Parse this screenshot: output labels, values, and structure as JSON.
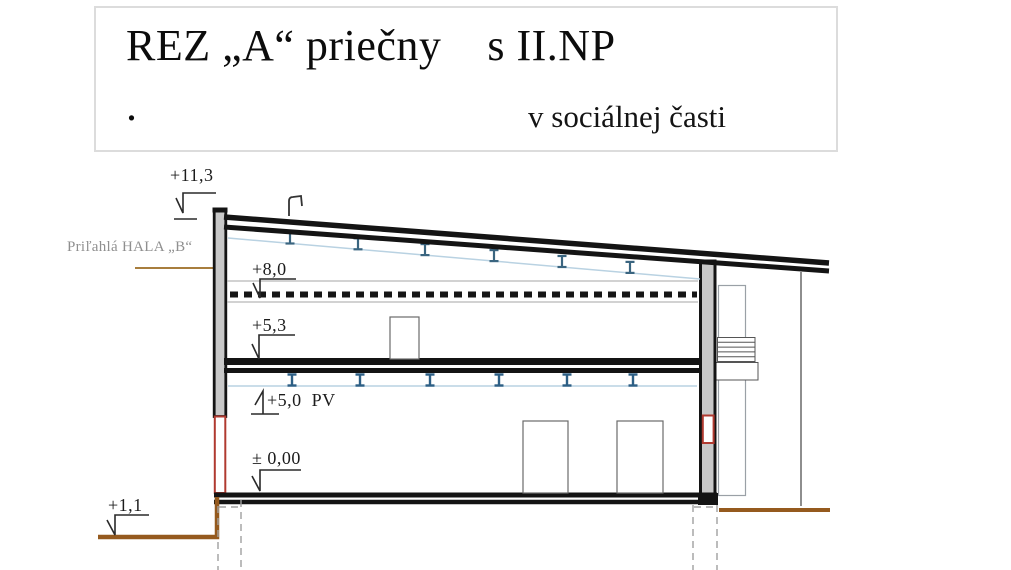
{
  "title": {
    "main": "REZ „A“ priečny    s II.NP",
    "dot": ".",
    "subtitle": "v sociálnej časti"
  },
  "annotations": {
    "adjacent_hall_label": "Priľahlá HALA „B“"
  },
  "elevation_marks": [
    {
      "id": "plus-11-3",
      "label": "+11,3"
    },
    {
      "id": "plus-8-0",
      "label": "+8,0"
    },
    {
      "id": "plus-5-3",
      "label": "+5,3"
    },
    {
      "id": "plus-5-0-pv",
      "label": "+5,0  PV"
    },
    {
      "id": "zero-0-00",
      "label": "± 0,00"
    },
    {
      "id": "plus-1-1",
      "label": "+1,1"
    }
  ],
  "colors": {
    "steel_beam_blue": "#2d5f85",
    "purlin_line_blue": "#b9d2e2",
    "ground_brown": "#955a1e",
    "opening_red": "#b03a30",
    "wall_gray": "#c8c8c8",
    "hall_label_gray": "#8f8f8f",
    "leader_tan": "#a87e3e",
    "line_black": "#141414"
  }
}
